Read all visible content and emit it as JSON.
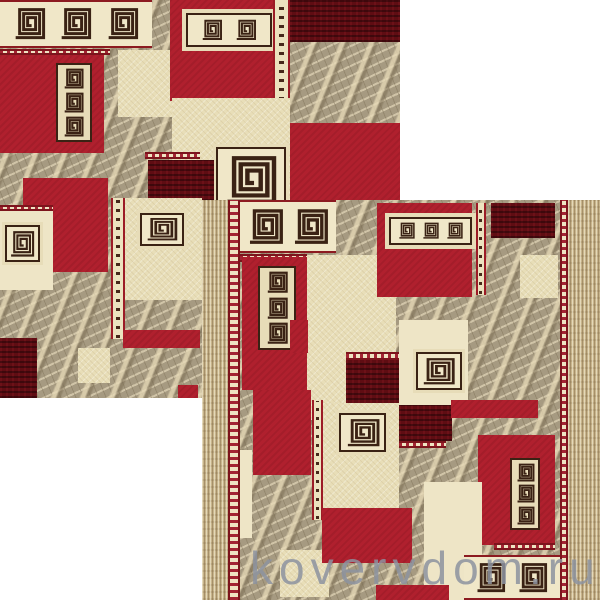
{
  "watermark": {
    "text": "kovervdom.ru"
  },
  "palette": {
    "background": "#ffffff",
    "red": "#b0202e",
    "maroon": "#5f0d13",
    "cream": "#eee5c6",
    "marble": "#a69a81",
    "tan_border": "#c8b58c",
    "meander": "#3a2214",
    "guard_red": "#9c1b26",
    "watermark_gray": "#8d93a0"
  },
  "carpets": [
    {
      "name": "carpet-photo-back",
      "rect": [
        0,
        0,
        400,
        398
      ],
      "borders": null,
      "blocks": [
        [
          "band",
          0,
          0,
          38,
          12
        ],
        [
          "guardh",
          0,
          12.2,
          27.5,
          1.6
        ],
        [
          "red",
          0,
          13.8,
          26,
          24.6
        ],
        [
          "motif3",
          14,
          15.8,
          9,
          20
        ],
        [
          "creamtex",
          29.5,
          12.5,
          15,
          17
        ],
        [
          "red",
          42.5,
          0,
          27,
          25.3
        ],
        [
          "bandstrip",
          46.5,
          3.3,
          21.5,
          8.6
        ],
        [
          "stripv",
          68.25,
          0,
          4.25,
          25.3
        ],
        [
          "maroon",
          72.5,
          0,
          27.5,
          10.5
        ],
        [
          "red",
          71.75,
          31,
          28.25,
          25
        ],
        [
          "creamtex",
          43,
          24.6,
          29.5,
          29.2
        ],
        [
          "motif1",
          54,
          37,
          17.5,
          16.5
        ],
        [
          "guardh",
          36.25,
          38.2,
          13.75,
          1.8
        ],
        [
          "maroon",
          37,
          40.2,
          16.5,
          10.3
        ],
        [
          "creamtex",
          31.25,
          49.8,
          19.25,
          25.7
        ],
        [
          "motif1",
          35,
          53.5,
          11,
          8.3
        ],
        [
          "red",
          5.75,
          44.7,
          21.25,
          23.6
        ],
        [
          "cream",
          0,
          51.5,
          13.3,
          21.4
        ],
        [
          "guardh",
          0,
          51.5,
          13.3,
          1.6
        ],
        [
          "motif1",
          1.2,
          56.5,
          8.8,
          9.3
        ],
        [
          "stripv",
          27.8,
          49.8,
          3.5,
          35.4
        ],
        [
          "maroon",
          0,
          84.9,
          9.3,
          15.1
        ],
        [
          "red",
          30.8,
          82.9,
          19.2,
          4.5
        ],
        [
          "creamtex",
          19.5,
          87.4,
          8,
          8.8
        ],
        [
          "red",
          44.5,
          96.7,
          5,
          3.3
        ]
      ]
    },
    {
      "name": "carpet-photo-front",
      "rect": [
        202,
        200,
        398,
        400
      ],
      "borders": [
        26,
        12,
        8,
        32
      ],
      "blocks": [
        [
          "band",
          0,
          0,
          30,
          13.25
        ],
        [
          "guardh",
          0,
          13.5,
          21,
          2
        ],
        [
          "red",
          0.6,
          14.25,
          22,
          33.25
        ],
        [
          "motif3",
          5.6,
          16.5,
          12,
          21
        ],
        [
          "creamtex",
          20.8,
          13.75,
          28,
          41.25
        ],
        [
          "red",
          42.9,
          0.75,
          29.5,
          23.5
        ],
        [
          "bandstrip",
          46.6,
          4.25,
          25.8,
          7
        ],
        [
          "stripv",
          73.6,
          0.75,
          3.4,
          23
        ],
        [
          "maroon",
          78.3,
          0.75,
          20.2,
          8.75
        ],
        [
          "creamtex",
          87.6,
          13.75,
          11.8,
          10.75
        ],
        [
          "red",
          15.5,
          30,
          5.6,
          8.25
        ],
        [
          "guardh",
          33.2,
          38,
          16.5,
          2
        ],
        [
          "maroon",
          33.2,
          40,
          16.5,
          11.25
        ],
        [
          "cream",
          49.7,
          30,
          21.7,
          21.25
        ],
        [
          "motif1",
          55,
          38,
          14.3,
          9.5
        ],
        [
          "maroon",
          49.7,
          51.25,
          16.5,
          9
        ],
        [
          "guardh",
          49.7,
          60.25,
          14.6,
          1.75
        ],
        [
          "red",
          4,
          47.5,
          18.3,
          21.25
        ],
        [
          "cream",
          0,
          62.5,
          3.7,
          22
        ],
        [
          "stripv",
          22.4,
          50,
          3.4,
          30
        ],
        [
          "creamtex",
          25.8,
          50.75,
          23.9,
          29.25
        ],
        [
          "motif1",
          31,
          53.25,
          14.6,
          9.75
        ],
        [
          "red",
          66,
          50,
          27,
          4.5
        ],
        [
          "red",
          74.5,
          58.75,
          23.9,
          27.5
        ],
        [
          "motif3",
          84.5,
          64.5,
          9.3,
          18
        ],
        [
          "cream",
          57.5,
          70.5,
          18,
          29.5
        ],
        [
          "guardh",
          79.5,
          85.75,
          19,
          1.75
        ],
        [
          "band",
          69.9,
          88.75,
          30.1,
          11.25
        ],
        [
          "creamtex",
          12.4,
          87.5,
          15.5,
          11.75
        ],
        [
          "red",
          25.5,
          77,
          28.3,
          13.75
        ],
        [
          "red",
          42.5,
          96.25,
          22.7,
          3.75
        ]
      ]
    }
  ]
}
